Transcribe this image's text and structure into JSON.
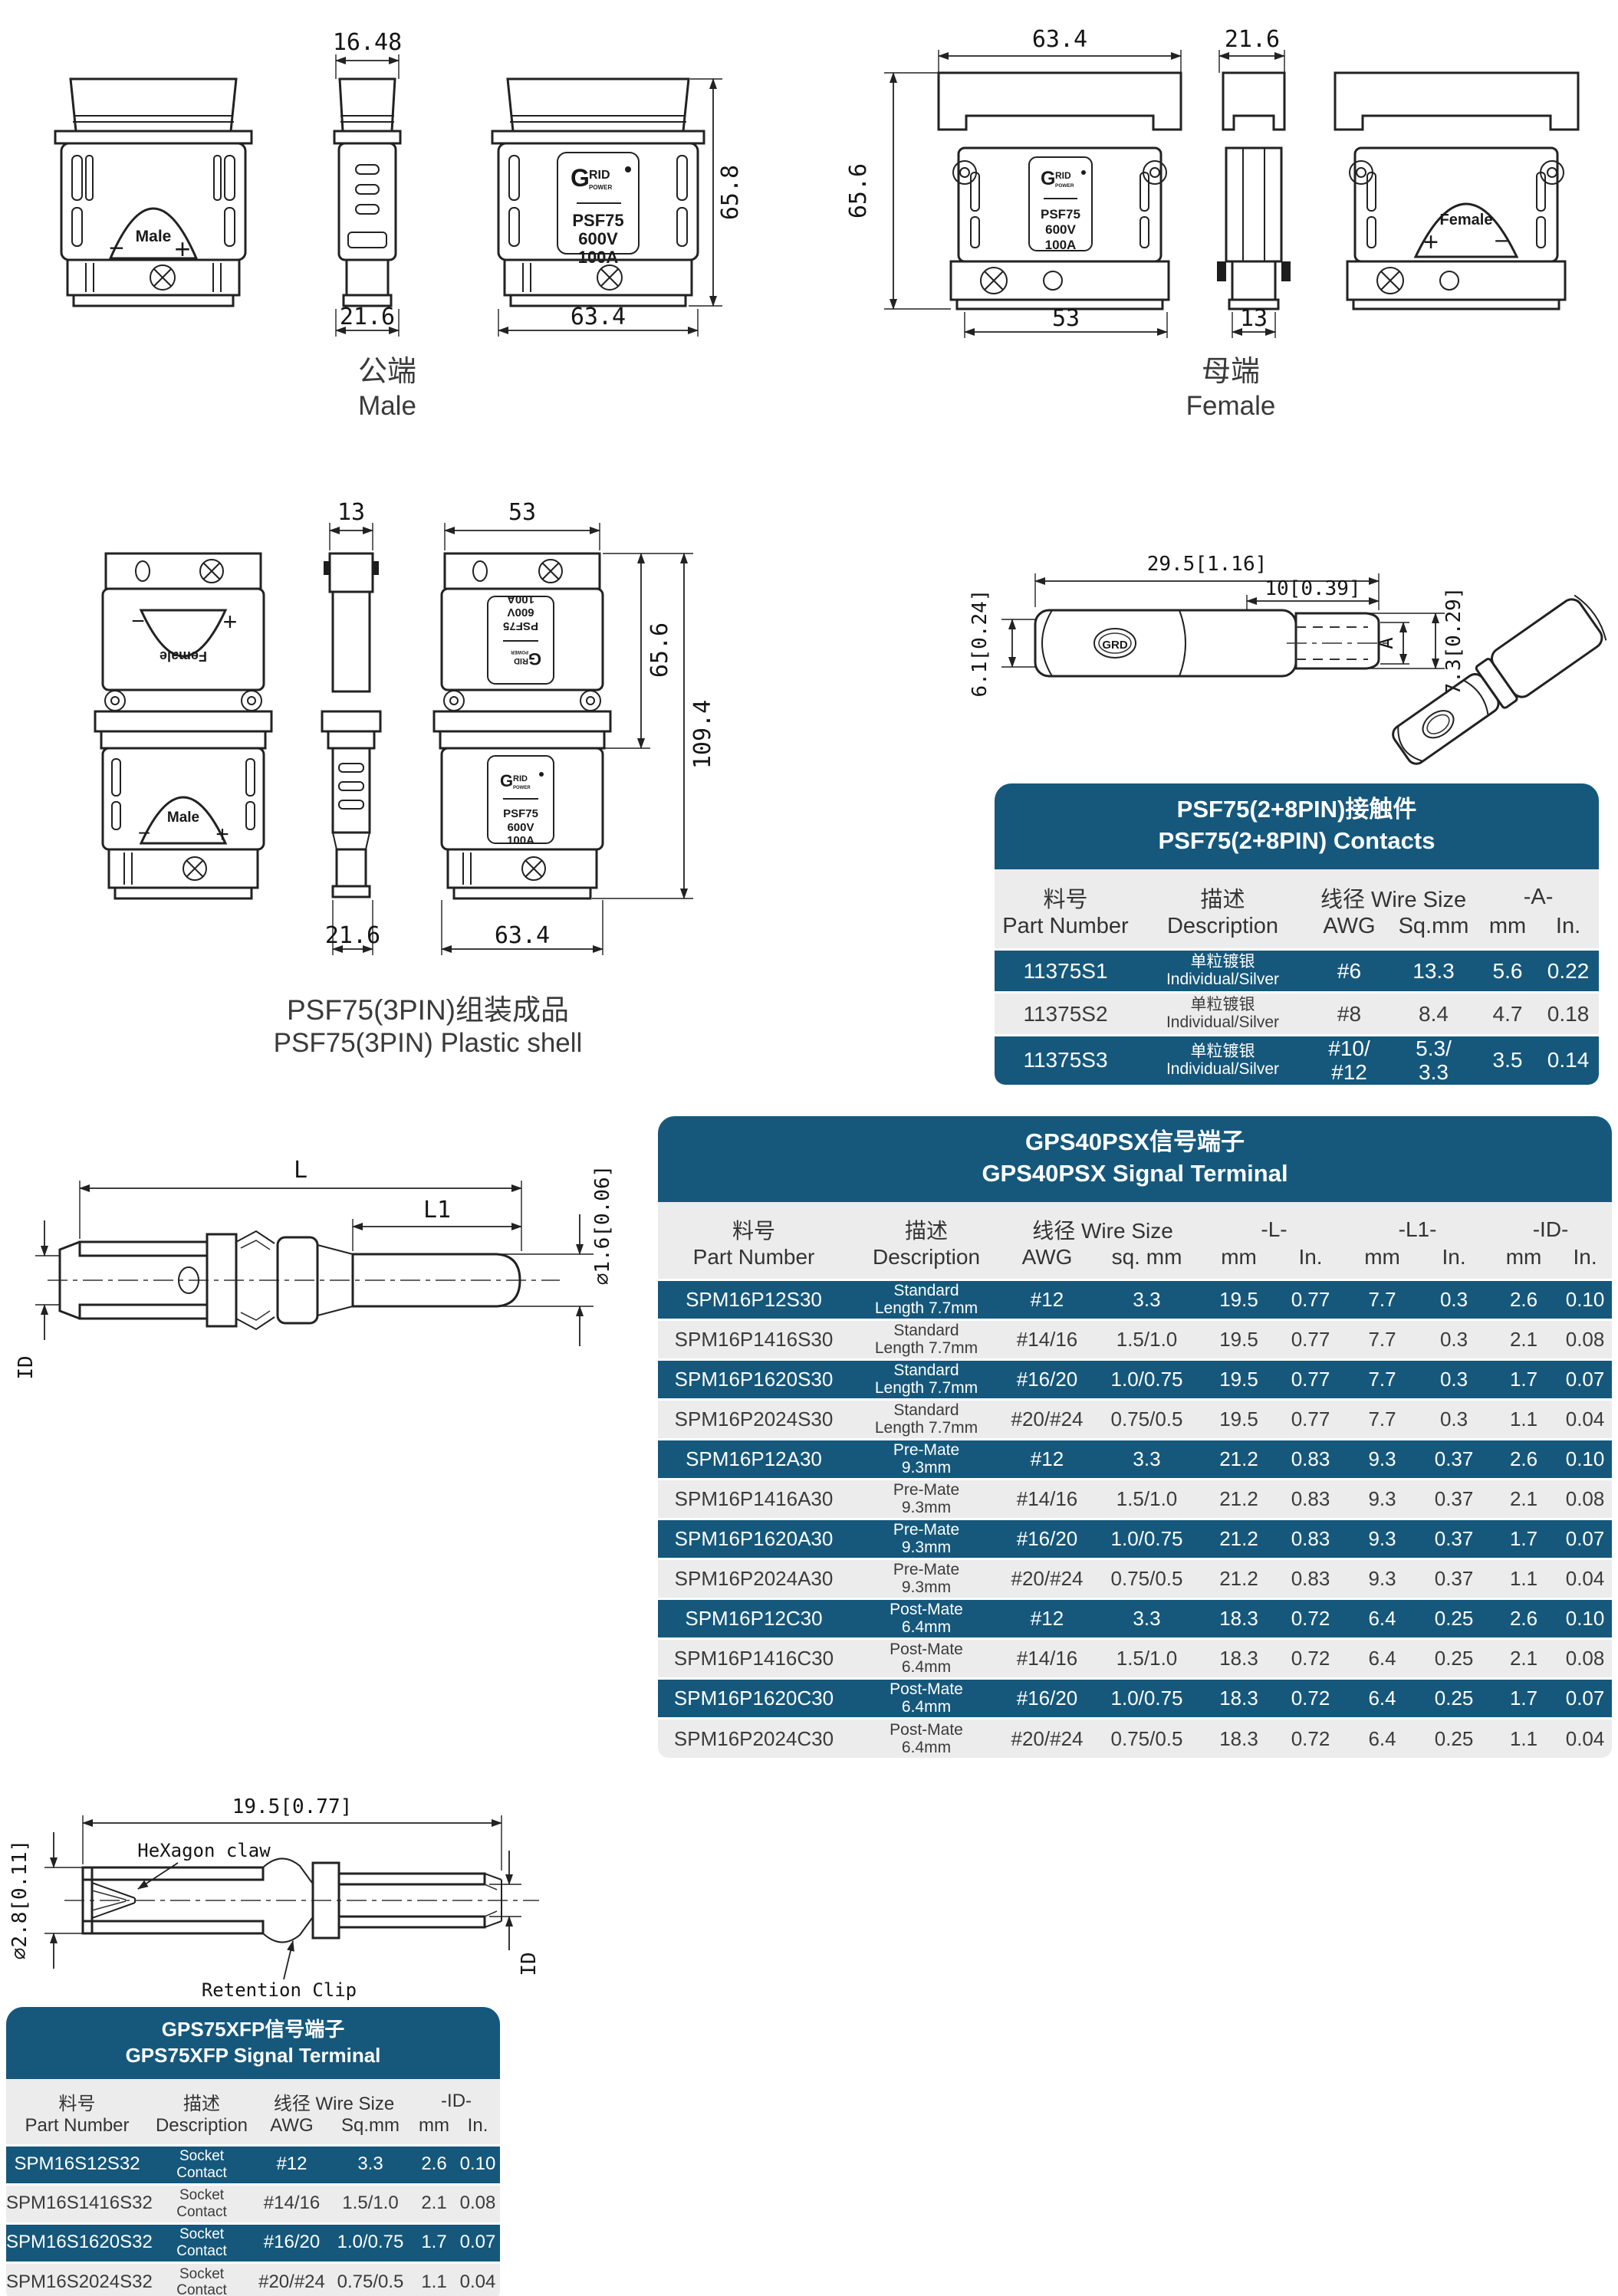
{
  "theme": {
    "accent": "#15587C",
    "row_light": "#ECECEC",
    "line": "#222222",
    "title_text": "#FFFFFF"
  },
  "brand": {
    "g": "G",
    "rid": "RID",
    "power": "POWER",
    "model": "PSF75",
    "volt": "600V",
    "amp": "100A",
    "contact_logo": "GRD"
  },
  "male": {
    "dim_top": "16.48",
    "dim_height": "65.8",
    "dim_side": "21.6",
    "dim_front": "63.4",
    "marking": "Male",
    "minus": "−",
    "plus": "+",
    "caption_cn": "公端",
    "caption_en": "Male"
  },
  "female": {
    "dim_front": "63.4",
    "dim_side": "21.6",
    "dim_height": "65.6",
    "dim_front_bottom": "53",
    "dim_side_bottom": "13",
    "marking": "Female",
    "plus": "+",
    "minus": "−",
    "caption_cn": "母端",
    "caption_en": "Female"
  },
  "shell": {
    "dim_side_top": "13",
    "dim_front_top": "53",
    "dim_h_upper": "65.6",
    "dim_h_total": "109.4",
    "dim_side_bottom": "21.6",
    "dim_front_bottom": "63.4",
    "marking_female": "Female",
    "marking_male": "Male",
    "minus": "−",
    "plus": "+",
    "caption_cn": "PSF75(3PIN)组装成品",
    "caption_en": "PSF75(3PIN) Plastic shell"
  },
  "contact_drawing": {
    "dim_len": "29.5[1.16]",
    "dim_tongue": "10[0.39]",
    "dim_h": "7.3[0.29]",
    "dim_d": "6.1[0.24]",
    "dim_a": "A"
  },
  "pin_drawing": {
    "dim_l": "L",
    "dim_l1": "L1",
    "dim_dia": "∅1.6[0.06]",
    "dim_id": "ID"
  },
  "socket_drawing": {
    "dim_len": "19.5[0.77]",
    "dim_dia": "∅2.8[0.11]",
    "dim_id": "ID",
    "label_claw": "HeXagon claw",
    "label_clip": "Retention Clip"
  },
  "contacts_table": {
    "title_cn": "PSF75(2+8PIN)接触件",
    "title_en": "PSF75(2+8PIN) Contacts",
    "h_part_cn": "料号",
    "h_part_en": "Part Number",
    "h_desc_cn": "描述",
    "h_desc_en": "Description",
    "h_wire": "线径 Wire Size",
    "h_awg": "AWG",
    "h_sqmm": "Sq.mm",
    "h_a": "-A-",
    "h_mm": "mm",
    "h_in": "In.",
    "rows": [
      {
        "part": "11375S1",
        "desc": [
          "单粒镀银",
          "Individual/Silver"
        ],
        "awg": "#6",
        "sqmm": "13.3",
        "mm": "5.6",
        "inch": "0.22"
      },
      {
        "part": "11375S2",
        "desc": [
          "单粒镀银",
          "Individual/Silver"
        ],
        "awg": "#8",
        "sqmm": "8.4",
        "mm": "4.7",
        "inch": "0.18"
      },
      {
        "part": "11375S3",
        "desc": [
          "单粒镀银",
          "Individual/Silver"
        ],
        "awg": "#10/\n#12",
        "sqmm": "5.3/\n3.3",
        "mm": "3.5",
        "inch": "0.14"
      }
    ]
  },
  "gps40_table": {
    "title_cn": "GPS40PSX信号端子",
    "title_en": "GPS40PSX Signal Terminal",
    "h_part_cn": "料号",
    "h_part_en": "Part Number",
    "h_desc_cn": "描述",
    "h_desc_en": "Description",
    "h_wire": "线径 Wire Size",
    "h_awg": "AWG",
    "h_sqmm": "sq. mm",
    "h_l": "-L-",
    "h_l1": "-L1-",
    "h_id": "-ID-",
    "h_mm": "mm",
    "h_in": "In.",
    "rows": [
      {
        "part": "SPM16P12S30",
        "desc": [
          "Standard",
          "Length 7.7mm"
        ],
        "awg": "#12",
        "sqmm": "3.3",
        "l_mm": "19.5",
        "l_in": "0.77",
        "l1_mm": "7.7",
        "l1_in": "0.3",
        "id_mm": "2.6",
        "id_in": "0.10"
      },
      {
        "part": "SPM16P1416S30",
        "desc": [
          "Standard",
          "Length 7.7mm"
        ],
        "awg": "#14/16",
        "sqmm": "1.5/1.0",
        "l_mm": "19.5",
        "l_in": "0.77",
        "l1_mm": "7.7",
        "l1_in": "0.3",
        "id_mm": "2.1",
        "id_in": "0.08"
      },
      {
        "part": "SPM16P1620S30",
        "desc": [
          "Standard",
          "Length 7.7mm"
        ],
        "awg": "#16/20",
        "sqmm": "1.0/0.75",
        "l_mm": "19.5",
        "l_in": "0.77",
        "l1_mm": "7.7",
        "l1_in": "0.3",
        "id_mm": "1.7",
        "id_in": "0.07"
      },
      {
        "part": "SPM16P2024S30",
        "desc": [
          "Standard",
          "Length 7.7mm"
        ],
        "awg": "#20/#24",
        "sqmm": "0.75/0.5",
        "l_mm": "19.5",
        "l_in": "0.77",
        "l1_mm": "7.7",
        "l1_in": "0.3",
        "id_mm": "1.1",
        "id_in": "0.04"
      },
      {
        "part": "SPM16P12A30",
        "desc": [
          "Pre-Mate",
          "9.3mm"
        ],
        "awg": "#12",
        "sqmm": "3.3",
        "l_mm": "21.2",
        "l_in": "0.83",
        "l1_mm": "9.3",
        "l1_in": "0.37",
        "id_mm": "2.6",
        "id_in": "0.10"
      },
      {
        "part": "SPM16P1416A30",
        "desc": [
          "Pre-Mate",
          "9.3mm"
        ],
        "awg": "#14/16",
        "sqmm": "1.5/1.0",
        "l_mm": "21.2",
        "l_in": "0.83",
        "l1_mm": "9.3",
        "l1_in": "0.37",
        "id_mm": "2.1",
        "id_in": "0.08"
      },
      {
        "part": "SPM16P1620A30",
        "desc": [
          "Pre-Mate",
          "9.3mm"
        ],
        "awg": "#16/20",
        "sqmm": "1.0/0.75",
        "l_mm": "21.2",
        "l_in": "0.83",
        "l1_mm": "9.3",
        "l1_in": "0.37",
        "id_mm": "1.7",
        "id_in": "0.07"
      },
      {
        "part": "SPM16P2024A30",
        "desc": [
          "Pre-Mate",
          "9.3mm"
        ],
        "awg": "#20/#24",
        "sqmm": "0.75/0.5",
        "l_mm": "21.2",
        "l_in": "0.83",
        "l1_mm": "9.3",
        "l1_in": "0.37",
        "id_mm": "1.1",
        "id_in": "0.04"
      },
      {
        "part": "SPM16P12C30",
        "desc": [
          "Post-Mate",
          "6.4mm"
        ],
        "awg": "#12",
        "sqmm": "3.3",
        "l_mm": "18.3",
        "l_in": "0.72",
        "l1_mm": "6.4",
        "l1_in": "0.25",
        "id_mm": "2.6",
        "id_in": "0.10"
      },
      {
        "part": "SPM16P1416C30",
        "desc": [
          "Post-Mate",
          "6.4mm"
        ],
        "awg": "#14/16",
        "sqmm": "1.5/1.0",
        "l_mm": "18.3",
        "l_in": "0.72",
        "l1_mm": "6.4",
        "l1_in": "0.25",
        "id_mm": "2.1",
        "id_in": "0.08"
      },
      {
        "part": "SPM16P1620C30",
        "desc": [
          "Post-Mate",
          "6.4mm"
        ],
        "awg": "#16/20",
        "sqmm": "1.0/0.75",
        "l_mm": "18.3",
        "l_in": "0.72",
        "l1_mm": "6.4",
        "l1_in": "0.25",
        "id_mm": "1.7",
        "id_in": "0.07"
      },
      {
        "part": "SPM16P2024C30",
        "desc": [
          "Post-Mate",
          "6.4mm"
        ],
        "awg": "#20/#24",
        "sqmm": "0.75/0.5",
        "l_mm": "18.3",
        "l_in": "0.72",
        "l1_mm": "6.4",
        "l1_in": "0.25",
        "id_mm": "1.1",
        "id_in": "0.04"
      }
    ]
  },
  "gps75_table": {
    "title_cn": "GPS75XFP信号端子",
    "title_en": "GPS75XFP Signal Terminal",
    "h_part_cn": "料号",
    "h_part_en": "Part Number",
    "h_desc_cn": "描述",
    "h_desc_en": "Description",
    "h_wire": "线径 Wire Size",
    "h_awg": "AWG",
    "h_sqmm": "Sq.mm",
    "h_id": "-ID-",
    "h_mm": "mm",
    "h_in": "In.",
    "rows": [
      {
        "part": "SPM16S12S32",
        "desc": [
          "Socket",
          "Contact"
        ],
        "awg": "#12",
        "sqmm": "3.3",
        "mm": "2.6",
        "inch": "0.10"
      },
      {
        "part": "SPM16S1416S32",
        "desc": [
          "Socket",
          "Contact"
        ],
        "awg": "#14/16",
        "sqmm": "1.5/1.0",
        "mm": "2.1",
        "inch": "0.08"
      },
      {
        "part": "SPM16S1620S32",
        "desc": [
          "Socket",
          "Contact"
        ],
        "awg": "#16/20",
        "sqmm": "1.0/0.75",
        "mm": "1.7",
        "inch": "0.07"
      },
      {
        "part": "SPM16S2024S32",
        "desc": [
          "Socket",
          "Contact"
        ],
        "awg": "#20/#24",
        "sqmm": "0.75/0.5",
        "mm": "1.1",
        "inch": "0.04"
      }
    ]
  }
}
